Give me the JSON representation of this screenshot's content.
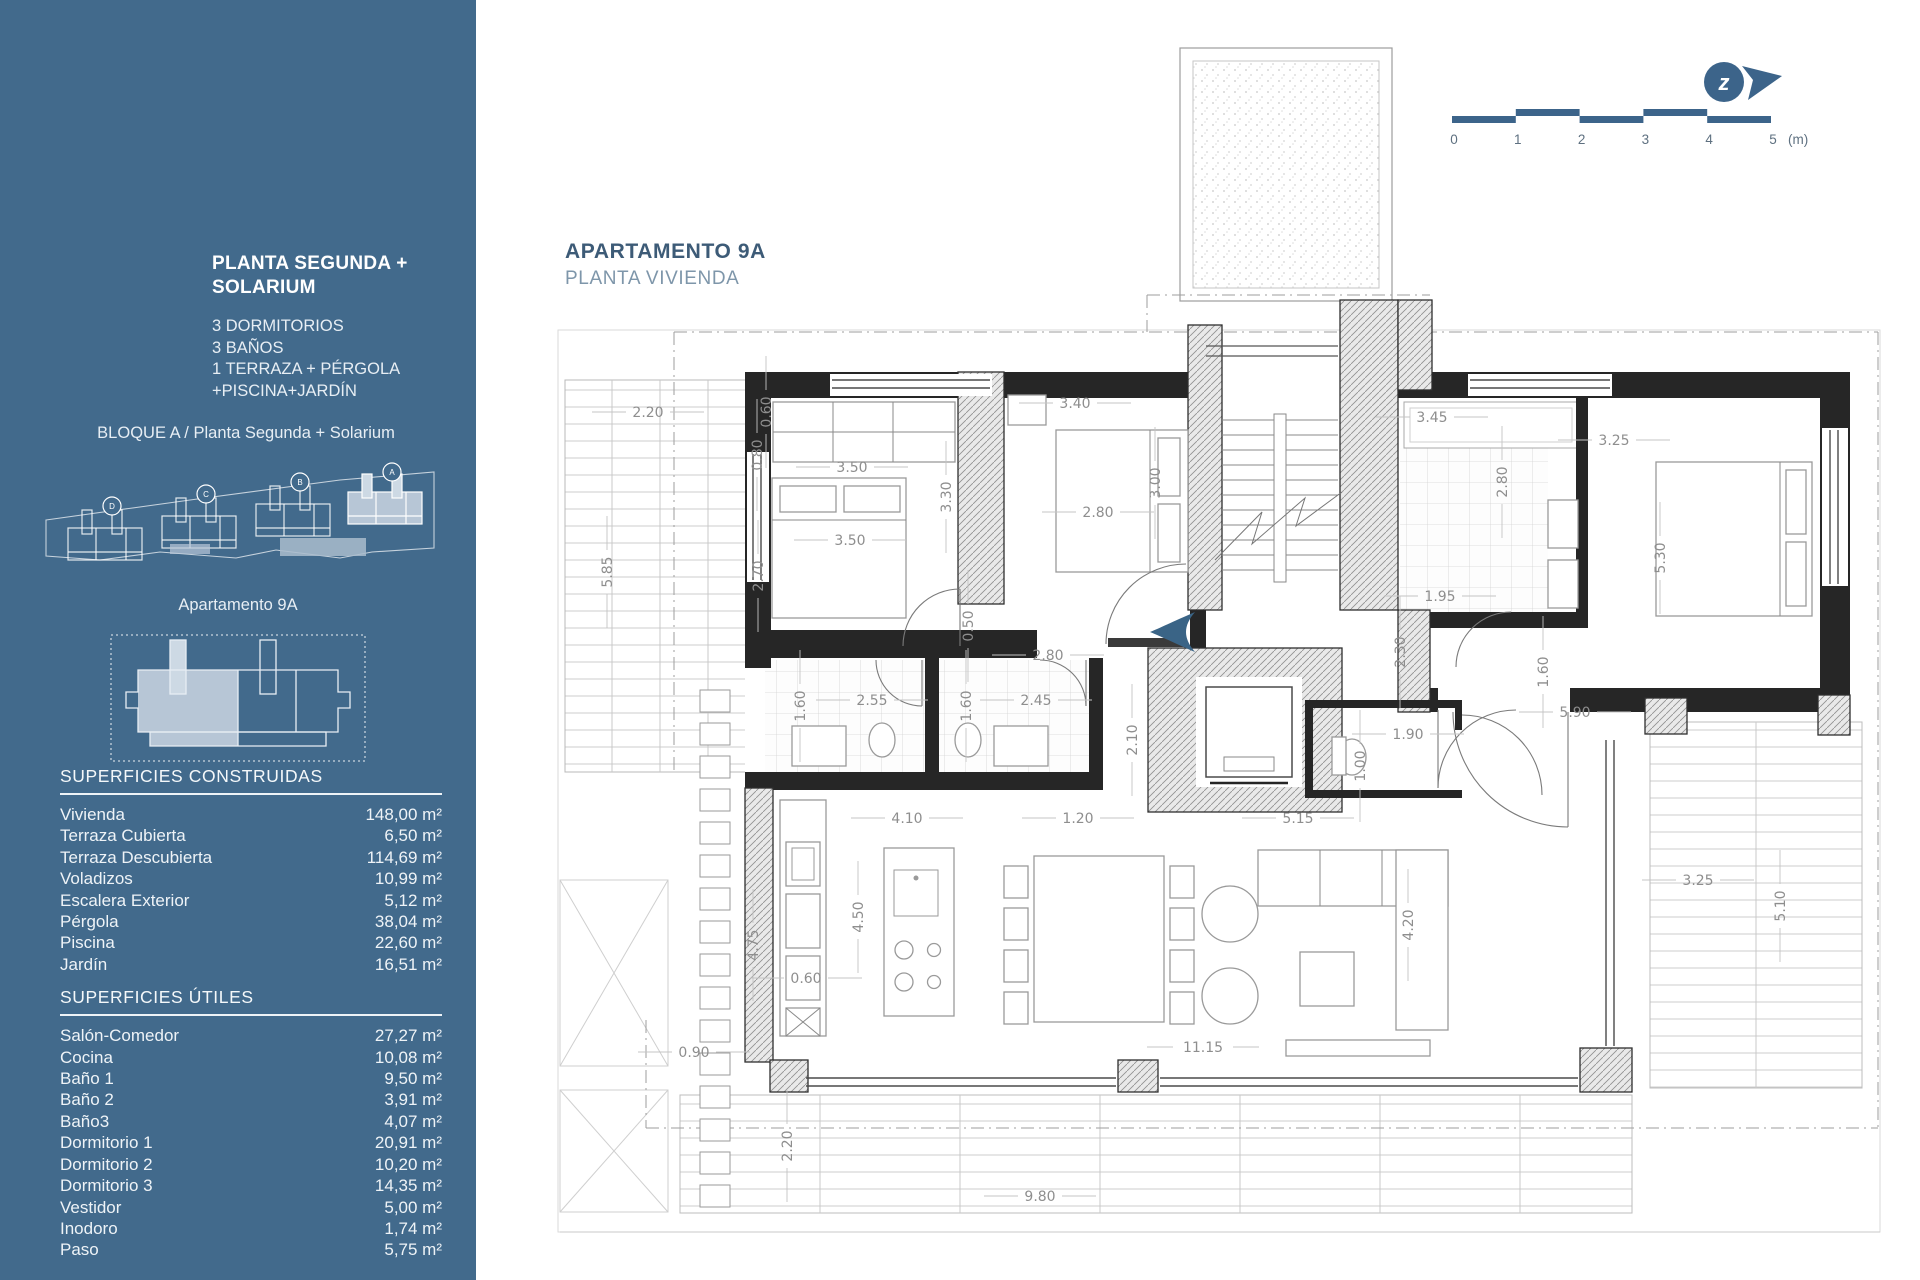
{
  "sidebar": {
    "plan_title": "PLANTA SEGUNDA + SOLARIUM",
    "features": [
      "3 DORMITORIOS",
      "3 BAÑOS",
      "1 TERRAZA + PÉRGOLA",
      "+PISCINA+JARDÍN"
    ],
    "block_label": "BLOQUE A / Planta Segunda + Solarium",
    "site_buildings": [
      "D",
      "C",
      "B",
      "A"
    ],
    "apartment_label": "Apartamento 9A",
    "surfaces_built": {
      "heading": "SUPERFICIES CONSTRUIDAS",
      "rows": [
        [
          "Vivienda",
          "148,00 m²"
        ],
        [
          "Terraza Cubierta",
          "6,50 m²"
        ],
        [
          "Terraza Descubierta",
          "114,69 m²"
        ],
        [
          "Voladizos",
          "10,99 m²"
        ],
        [
          "Escalera Exterior",
          "5,12 m²"
        ],
        [
          "Pérgola",
          "38,04 m²"
        ],
        [
          "Piscina",
          "22,60 m²"
        ],
        [
          "Jardín",
          "16,51 m²"
        ]
      ]
    },
    "surfaces_useful": {
      "heading": "SUPERFICIES ÚTILES",
      "rows": [
        [
          "Salón-Comedor",
          "27,27 m²"
        ],
        [
          "Cocina",
          "10,08 m²"
        ],
        [
          "Baño 1",
          "9,50 m²"
        ],
        [
          "Baño 2",
          "3,91 m²"
        ],
        [
          "Baño3",
          "4,07 m²"
        ],
        [
          "Dormitorio 1",
          "20,91 m²"
        ],
        [
          "Dormitorio 2",
          "10,20 m²"
        ],
        [
          "Dormitorio 3",
          "14,35 m²"
        ],
        [
          "Vestidor",
          "5,00 m²"
        ],
        [
          "Inodoro",
          "1,74 m²"
        ],
        [
          "Paso",
          "5,75 m²"
        ]
      ]
    }
  },
  "header": {
    "title": "APARTAMENTO 9A",
    "subtitle": "PLANTA VIVIENDA"
  },
  "scale_bar": {
    "ticks": [
      "0",
      "1",
      "2",
      "3",
      "4",
      "5"
    ],
    "unit": "(m)"
  },
  "north_icon": {
    "letter": "z"
  },
  "colors": {
    "sidebar_bg": "#426a8c",
    "accent": "#3c648a",
    "highlight": "#b7c6d6",
    "entry_arrow": "#3a6486"
  },
  "plan": {
    "dimension_labels": [
      {
        "t": "2.20",
        "x": 648,
        "y": 412,
        "r": 0
      },
      {
        "t": "5.85",
        "x": 607,
        "y": 572,
        "r": 1
      },
      {
        "t": "0.60",
        "x": 766,
        "y": 412,
        "r": 1
      },
      {
        "t": "0.80",
        "x": 757,
        "y": 455,
        "r": 1
      },
      {
        "t": "3.50",
        "x": 852,
        "y": 467,
        "r": 0
      },
      {
        "t": "3.50",
        "x": 850,
        "y": 540,
        "r": 0
      },
      {
        "t": "2.70",
        "x": 758,
        "y": 576,
        "r": 1
      },
      {
        "t": "0.50",
        "x": 968,
        "y": 626,
        "r": 1
      },
      {
        "t": "3.30",
        "x": 946,
        "y": 497,
        "r": 1
      },
      {
        "t": "3.40",
        "x": 1075,
        "y": 403,
        "r": 0
      },
      {
        "t": "2.80",
        "x": 1098,
        "y": 512,
        "r": 0
      },
      {
        "t": "3.00",
        "x": 1155,
        "y": 483,
        "r": 1
      },
      {
        "t": "2.80",
        "x": 1048,
        "y": 655,
        "r": 0
      },
      {
        "t": "1.60",
        "x": 800,
        "y": 706,
        "r": 1
      },
      {
        "t": "2.55",
        "x": 872,
        "y": 700,
        "r": 0
      },
      {
        "t": "1.60",
        "x": 966,
        "y": 706,
        "r": 1
      },
      {
        "t": "2.45",
        "x": 1036,
        "y": 700,
        "r": 0
      },
      {
        "t": "2.10",
        "x": 1132,
        "y": 740,
        "r": 1
      },
      {
        "t": "3.45",
        "x": 1432,
        "y": 417,
        "r": 0
      },
      {
        "t": "2.80",
        "x": 1502,
        "y": 482,
        "r": 1
      },
      {
        "t": "1.95",
        "x": 1440,
        "y": 596,
        "r": 0
      },
      {
        "t": "2.30",
        "x": 1400,
        "y": 652,
        "r": 1
      },
      {
        "t": "3.25",
        "x": 1614,
        "y": 440,
        "r": 0
      },
      {
        "t": "5.30",
        "x": 1660,
        "y": 558,
        "r": 1
      },
      {
        "t": "1.60",
        "x": 1543,
        "y": 672,
        "r": 1
      },
      {
        "t": "5.90",
        "x": 1575,
        "y": 712,
        "r": 0
      },
      {
        "t": "1.90",
        "x": 1408,
        "y": 734,
        "r": 0
      },
      {
        "t": "1.00",
        "x": 1360,
        "y": 766,
        "r": 1
      },
      {
        "t": "4.10",
        "x": 907,
        "y": 818,
        "r": 0
      },
      {
        "t": "1.20",
        "x": 1078,
        "y": 818,
        "r": 0
      },
      {
        "t": "5.15",
        "x": 1298,
        "y": 818,
        "r": 0
      },
      {
        "t": "4.50",
        "x": 858,
        "y": 917,
        "r": 1
      },
      {
        "t": "0.60",
        "x": 806,
        "y": 978,
        "r": 0
      },
      {
        "t": "4.75",
        "x": 753,
        "y": 945,
        "r": 1
      },
      {
        "t": "0.90",
        "x": 694,
        "y": 1052,
        "r": 0
      },
      {
        "t": "11.15",
        "x": 1203,
        "y": 1047,
        "r": 0
      },
      {
        "t": "4.20",
        "x": 1408,
        "y": 925,
        "r": 1
      },
      {
        "t": "3.25",
        "x": 1698,
        "y": 880,
        "r": 0
      },
      {
        "t": "5.10",
        "x": 1780,
        "y": 906,
        "r": 1
      },
      {
        "t": "2.20",
        "x": 787,
        "y": 1146,
        "r": 1
      },
      {
        "t": "9.80",
        "x": 1040,
        "y": 1196,
        "r": 0
      }
    ]
  }
}
